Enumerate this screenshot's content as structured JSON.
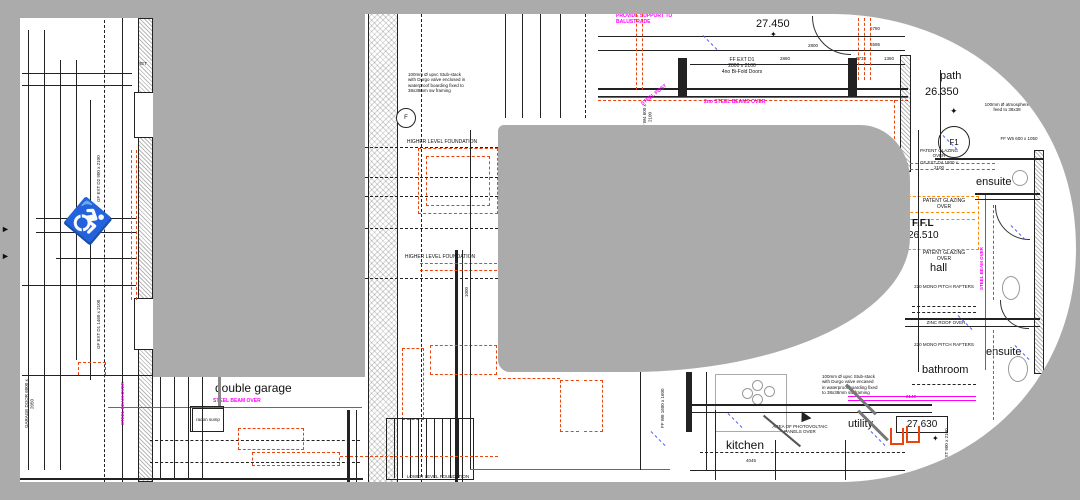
{
  "colors": {
    "background_gray": "#ababab",
    "foundation_red": "#e8450f",
    "steel_magenta": "#ff00ff",
    "services_green": "#00b400",
    "slope_blue": "#4455ff",
    "ffl_orange": "#ff8800"
  },
  "icons": {
    "level_marker": "✦",
    "wheelchair": "♿",
    "margin_arrow": "►"
  },
  "levels": {
    "upper": "27.450",
    "path_label": "path",
    "path_level": "26.350",
    "ffl_label": "F.F.L",
    "ffl_level": "26.510",
    "ground": "27.630"
  },
  "rooms": {
    "double_garage": "double garage",
    "kitchen": "kitchen",
    "utility": "utility",
    "bathroom": "bathroom",
    "ensuite_upper": "ensuite",
    "ensuite_lower": "ensuite",
    "hall": "hall"
  },
  "notes": {
    "balustrade": "PROVIDE SUPPORT TO BALUSTRADE",
    "steel_beams": "2no STEEL BEAMS OVER",
    "steel_beam": "STEEL BEAM OVER",
    "steel_post": "STEEL POST",
    "stub_stack_a": "100mm Ø upvc Stub-stack with Durgo valve enclosed in waterproof boarding fixed to 38x38mm sw framing",
    "stub_stack_b": "100mm Ø upvc Stub-stack with Durgo valve encased in waterproof boarding fixed to 38x38mm sw framing",
    "atmosphere": "100mm Ø atmosphere feed to 38x38",
    "hlf": "HIGHER LEVEL FOUNDATION",
    "llf": "LOWER LEVEL FOUNDATION",
    "patent_glazing": "PATENT GLAZING OVER",
    "rafters": "220 MONO PITCH RAFTERS",
    "zinc": "ZINC ROOF OVER",
    "pv": "AREA OF PHOTOVOLTAIC PANELS OVER",
    "radon": "radon sump",
    "tanking": "TANKING MEMBRANE"
  },
  "openings": {
    "ff_ext_d1_name": "FF EXT D1",
    "ff_ext_d1_size": "2800 x 2100",
    "ff_ext_d1_desc": "4no Bi-Fold Doors",
    "gf_ext_d4": "GF EXT D4 1800 x 2100",
    "gf_ext_d2": "GF EXT D2 900 x 2100",
    "gf_ext_d1": "GF EXT D1 1460 x 2100",
    "gf_ext_d3": "GF EXT 900 x 2100",
    "garage_door": "GARAGE DOOR 6000 x 2050",
    "ff_w4": "FF W4 600 x 2100",
    "ff_w5": "FF W5 600 x 1050",
    "ff_w8": "FF W8 1600 x 1600"
  },
  "dims": {
    "d1": "6780",
    "d2": "6595",
    "d3": "2800",
    "d4": "6733",
    "d5": "2860",
    "d6": "1360",
    "d7": "4045",
    "d8": "2140",
    "d9": "1000"
  },
  "refs": {
    "f1": "F1",
    "f": "F",
    "ret": "RET"
  }
}
